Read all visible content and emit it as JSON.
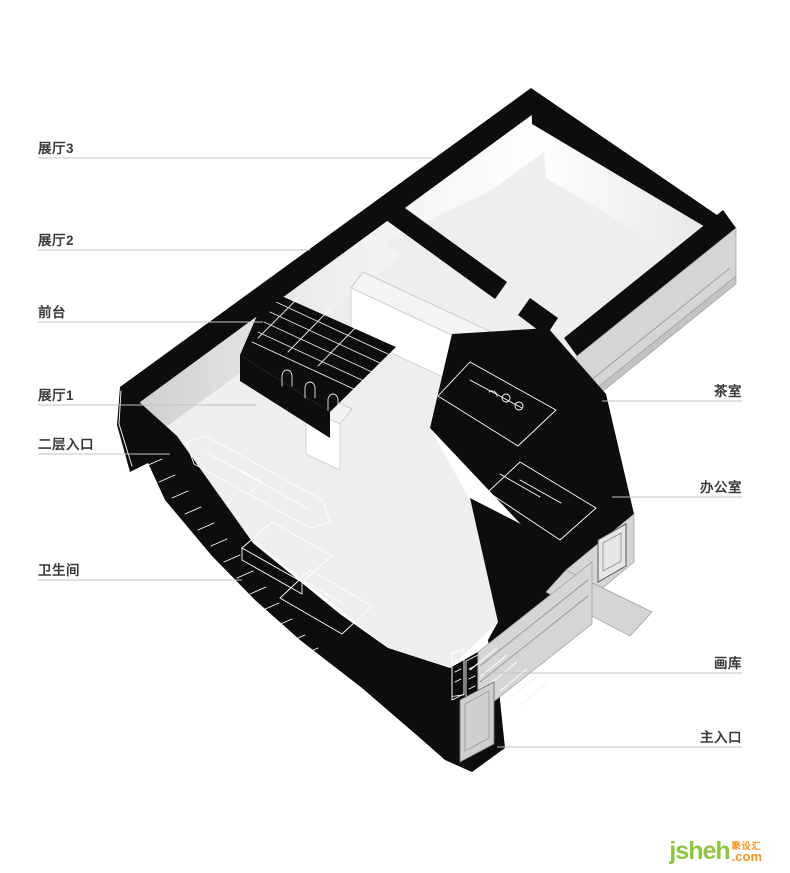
{
  "diagram": {
    "type": "axonometric-floor-plan",
    "labels_left": [
      {
        "text": "展厅3"
      },
      {
        "text": "展厅2"
      },
      {
        "text": "前台"
      },
      {
        "text": "展厅1"
      },
      {
        "text": "二层入口"
      },
      {
        "text": "卫生间"
      }
    ],
    "labels_right": [
      {
        "text": "茶室"
      },
      {
        "text": "办公室"
      },
      {
        "text": "画库"
      },
      {
        "text": "主入口"
      }
    ]
  },
  "watermark": {
    "name": "jsheh",
    "cjk": "聚设汇",
    "tld": ".com",
    "green": "#8dc63f",
    "orange": "#f7941d"
  },
  "palette": {
    "wall_black": "#0d0d0d",
    "floor_gray": "#eeeeee",
    "facade_gray": "#d5d5d5",
    "inner_face_light": "#ffffff",
    "inner_face_shade": "#d6d6d6",
    "leader_line": "#c3c3c3",
    "label_text": "#3a3a3a"
  }
}
